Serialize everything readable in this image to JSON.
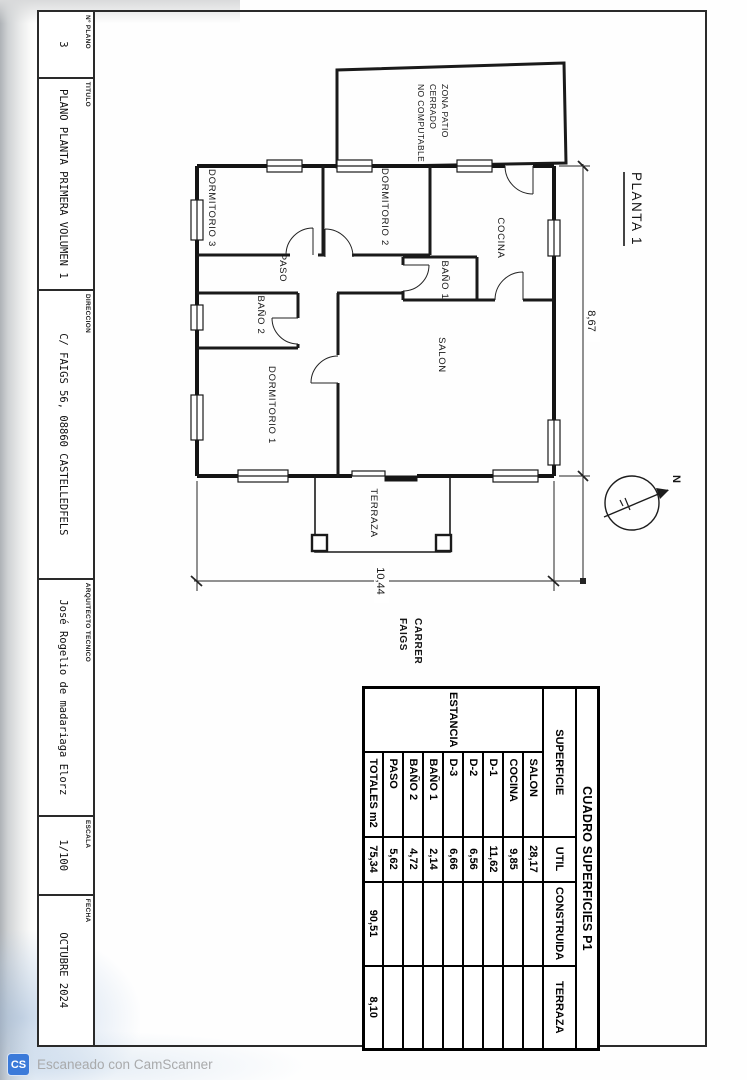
{
  "title_block": {
    "numero_plano": {
      "label": "Nº PLANO",
      "value": "3"
    },
    "titulo": {
      "label": "TITULO",
      "value": "PLANO PLANTA PRIMERA VOLUMEN 1"
    },
    "direccion": {
      "label": "DIRECCION",
      "value": "C/ FAIGS 56, 08860 CASTELLEDFELS"
    },
    "arquitecto": {
      "label": "ARQUITECTO TECNICO",
      "value": "José Rogelio de madariaga Elorz"
    },
    "escala": {
      "label": "ESCALA",
      "value": "1/100"
    },
    "fecha": {
      "label": "FECHA",
      "value": "OCTUBRE 2024"
    }
  },
  "plan": {
    "sheet_title": "PLANTA 1",
    "rooms": {
      "dormitorio3": "DORMITORIO 3",
      "dormitorio2": "DORMITORIO 2",
      "cocina": "COCINA",
      "paso": "PASO",
      "bano1": "BAÑO 1",
      "bano2": "BAÑO 2",
      "dormitorio1": "DORMITORIO 1",
      "salon": "SALON",
      "terraza": "TERRAZA"
    },
    "patio_label": {
      "line1": "ZONA PATIO",
      "line2": "CERRADO",
      "line3": "NO COMPUTABLE"
    },
    "street": {
      "line1": "CARRER",
      "line2": "FAIGS"
    },
    "dimensions": {
      "width": "8,67",
      "height": "10,44"
    },
    "north_label": "N"
  },
  "areas_table": {
    "title": "CUADRO SUPERFICIES P1",
    "estancia_header": "ESTANCIA",
    "headers": {
      "superficie": "SUPERFICIE",
      "util": "UTIL",
      "construida": "CONSTRUIDA",
      "terraza": "TERRAZA"
    },
    "rows": [
      {
        "name": "SALON",
        "util": "28,17"
      },
      {
        "name": "COCINA",
        "util": "9,85"
      },
      {
        "name": "D-1",
        "util": "11,62"
      },
      {
        "name": "D-2",
        "util": "6,56"
      },
      {
        "name": "D-3",
        "util": "6,66"
      },
      {
        "name": "BAÑO 1",
        "util": "2,14"
      },
      {
        "name": "BAÑO 2",
        "util": "4,72"
      },
      {
        "name": "PASO",
        "util": "5,62"
      }
    ],
    "totals": {
      "name": "TOTALES m2",
      "util": "75,34",
      "construida": "90,51",
      "terraza": "8,10"
    }
  },
  "watermark": {
    "badge": "CS",
    "text": "Escaneado con CamScanner"
  },
  "colors": {
    "ink": "#1b1b1b",
    "watermark_blue": "#3b7ad9",
    "paper": "#fefefe"
  }
}
